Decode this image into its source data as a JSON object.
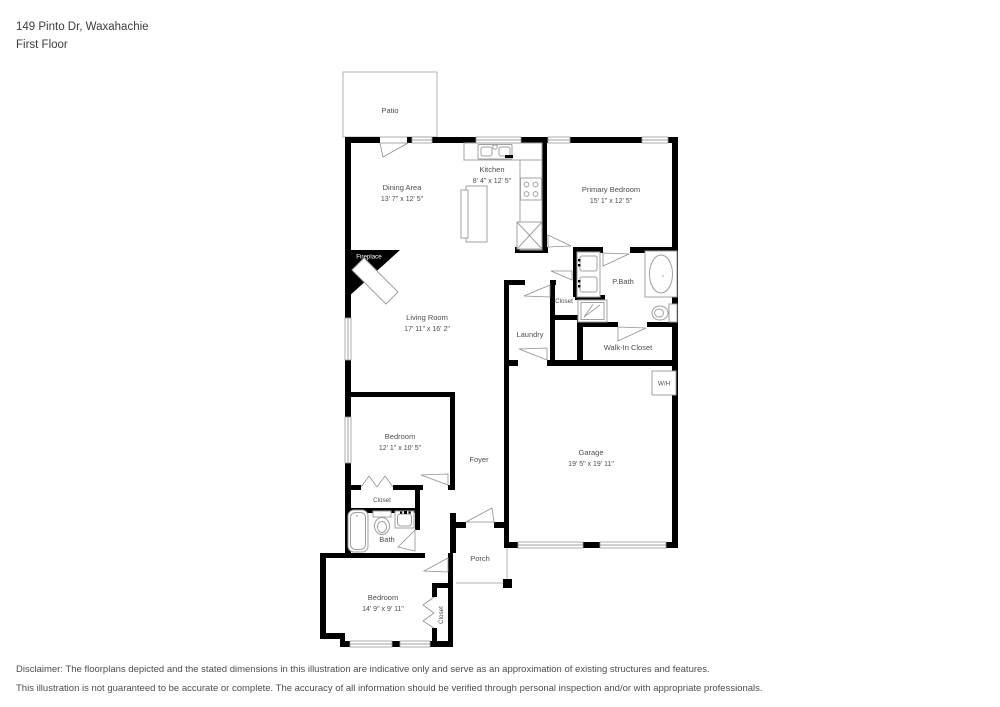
{
  "header": {
    "address": "149 Pinto Dr, Waxahachie",
    "floor": "First Floor"
  },
  "rooms": {
    "patio": {
      "label": "Patio"
    },
    "dining": {
      "label": "Dining Area",
      "dims": "13' 7\" x 12' 5\""
    },
    "kitchen": {
      "label": "Kitchen",
      "dims": "8' 4\" x 12' 5\""
    },
    "primary_bedroom": {
      "label": "Primary Bedroom",
      "dims": "15' 1\" x 12' 5\""
    },
    "living": {
      "label": "Living Room",
      "dims": "17' 11\" x 16' 2\""
    },
    "fireplace": {
      "label": "Fireplace"
    },
    "pbath": {
      "label": "P.Bath"
    },
    "hall_closet": {
      "label": "Closet"
    },
    "laundry": {
      "label": "Laundry"
    },
    "walk_in_closet": {
      "label": "Walk-In Closet"
    },
    "water_heater": {
      "label": "W/H"
    },
    "garage": {
      "label": "Garage",
      "dims": "19' 5\" x 19' 11\""
    },
    "foyer": {
      "label": "Foyer"
    },
    "bedroom2": {
      "label": "Bedroom",
      "dims": "12' 1\" x 10' 5\""
    },
    "closet2": {
      "label": "Closet"
    },
    "bath": {
      "label": "Bath"
    },
    "bedroom3": {
      "label": "Bedroom",
      "dims": "14' 9\" x 9' 11\""
    },
    "closet3": {
      "label": "Closet"
    },
    "porch": {
      "label": "Porch"
    }
  },
  "disclaimer": {
    "line1": "Disclaimer: The floorplans depicted and the stated dimensions in this illustration are indicative only and serve as an approximation of existing structures and features.",
    "line2": "This illustration is not guaranteed to be accurate or complete. The accuracy of all information should be verified through personal inspection and/or with appropriate professionals."
  },
  "colors": {
    "wall": "#000000",
    "label": "#4d4d4d",
    "fixture": "#a0a0a0"
  }
}
